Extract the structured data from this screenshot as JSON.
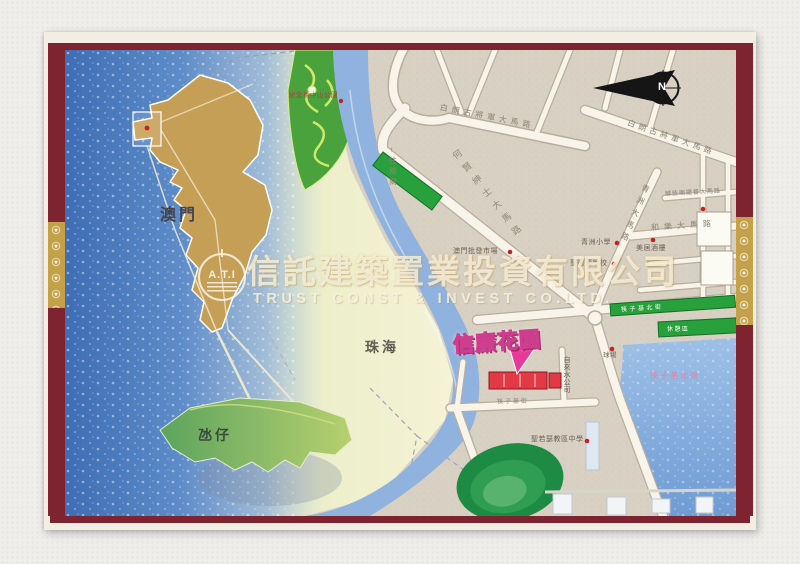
{
  "regions": {
    "macau": "澳門",
    "zhuhai": "珠海",
    "taipa": "氹仔"
  },
  "compass": {
    "north": "N"
  },
  "watermark": {
    "logo": "A.T.I",
    "company_cn": "信託建築置業投資有限公司",
    "company_en": "TRUST CONST & INVEST CO.LTD."
  },
  "highlight": {
    "name": "信廉花園"
  },
  "roads": {
    "castelo_branco": "白朗古將軍大馬路",
    "ho_yin": "何賢紳士大馬路",
    "to_border_gate": "←往關閘",
    "venceslau": "和樂大馬路",
    "ilha_verde": "青洲大馬路",
    "almirante": "罅些喇提督大馬路",
    "fai_chi_kei_street": "筷子基街"
  },
  "pois": {
    "park": "紀念孫中山公園",
    "wholesale_market": "澳門批發市場",
    "ilha_verde_school": "青洲小學",
    "santa_teresa_school": "聖德蘭學校",
    "mei_koi_restaurant": "美居酒樓",
    "sports_court": "球場",
    "water_company": "自來水公司",
    "st_joseph_school": "聖若瑟教區中學",
    "bay": "筷子基北灣",
    "north_street": "筷子基北街",
    "leisure_area": "休憩區"
  },
  "colors": {
    "frame_maroon": "#7d2430",
    "frame_gold": "#c3a14a",
    "highlight_building": "#e23944",
    "highlight_label": "#ffe616",
    "bubble_magenta": "#e83898",
    "sea_blue": "#4a78bc",
    "strip_green": "#28a13c"
  }
}
